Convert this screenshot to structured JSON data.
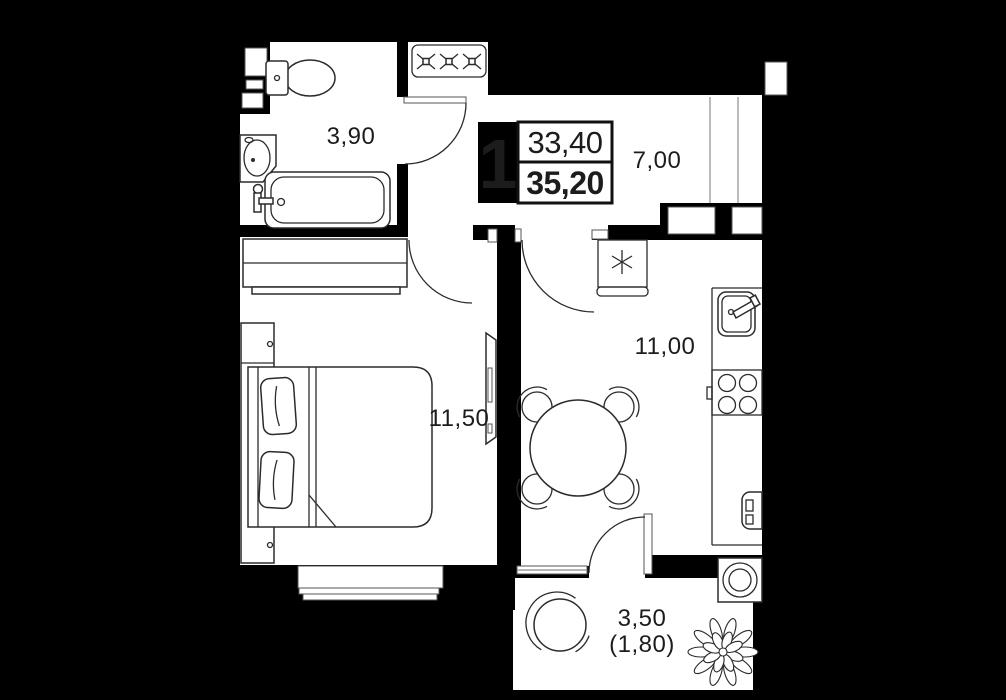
{
  "legend": {
    "room_count": "1",
    "living_area": "33,40",
    "total_area": "35,20"
  },
  "rooms": {
    "bathroom": {
      "area": "3,90"
    },
    "hallway": {
      "area": "7,00"
    },
    "bedroom": {
      "area": "11,50"
    },
    "kitchen": {
      "area": "11,00"
    },
    "balcony": {
      "area": "3,50",
      "area_weighted": "(1,80)"
    }
  },
  "colors": {
    "background": "#000000",
    "floor": "#ffffff",
    "outline": "#2b2b2b"
  }
}
